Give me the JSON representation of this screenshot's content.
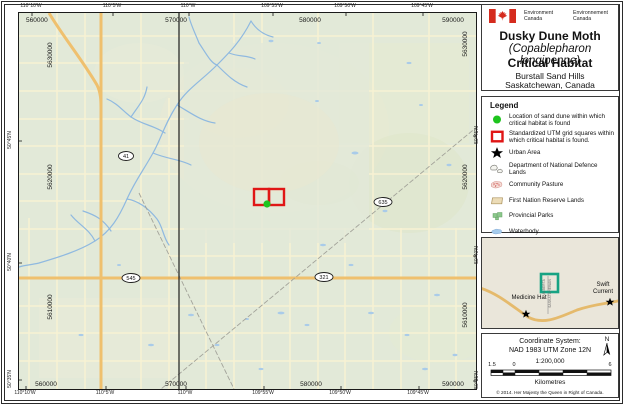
{
  "header": {
    "dept_en": "Environment\nCanada",
    "dept_fr": "Environnement\nCanada",
    "title_line1": "Dusky Dune Moth",
    "title_line2": "(Copablepharon longipenne)",
    "title_line3": "Critical Habitat",
    "subtitle_line1": "Burstall Sand Hills",
    "subtitle_line2": "Saskatchewan, Canada"
  },
  "legend": {
    "title": "Legend",
    "items": [
      {
        "symbol": "sand-dune-location-dot",
        "label": "Location of sand dune within which critical habitat is found"
      },
      {
        "symbol": "utm-grid-square",
        "label": "Standardized UTM grid squares within which critical habitat is found."
      },
      {
        "symbol": "urban-area-star",
        "label": "Urban Area"
      },
      {
        "symbol": "dnd-lands",
        "label": "Department of National Defence Lands"
      },
      {
        "symbol": "community-pasture",
        "label": "Community Pasture"
      },
      {
        "symbol": "first-nation-reserve-lands",
        "label": "First Nation Reserve Lands"
      },
      {
        "symbol": "provincial-parks",
        "label": "Provincial Parks"
      },
      {
        "symbol": "waterbody",
        "label": "Waterbody"
      },
      {
        "symbol": "province-state-boundary",
        "label": "Province/State Boundary"
      }
    ]
  },
  "map_labels": {
    "top_eastings": [
      "560000",
      "570000",
      "580000",
      "590000"
    ],
    "bottom_eastings": [
      "560000",
      "570000",
      "580000",
      "590000"
    ],
    "left_northings": [
      "5630000",
      "5620000",
      "5610000"
    ],
    "right_northings": [
      "5630000",
      "5620000",
      "5610000"
    ],
    "top_longitudes": [
      "110°10'W",
      "110°5'W",
      "110°W",
      "109°55'W",
      "109°50'W",
      "109°45'W"
    ],
    "bottom_longitudes": [
      "110°10'W",
      "110°5'W",
      "110°W",
      "109°55'W",
      "109°50'W",
      "109°45'W"
    ],
    "left_latitudes": [
      "50°45'N",
      "50°40'N",
      "50°35'N"
    ],
    "right_latitudes": [
      "50°45'N",
      "50°40'N",
      "50°35'N"
    ],
    "highways": {
      "h41": "41",
      "h635": "635",
      "h545": "545",
      "h321": "321"
    }
  },
  "inset": {
    "city1": "Medicine Hat",
    "city2": "Swift Current",
    "boundary_left": "ALBERTA",
    "boundary_right": "SASKATCHEWAN"
  },
  "footer": {
    "coord_line1": "Coordinate System:",
    "coord_line2": "NAD 1983 UTM Zone 12N",
    "scale_text": "1:200,000",
    "scalebar_left": "1.5",
    "scalebar_zero": "0",
    "scalebar_right": "6",
    "scalebar_unit": "Kilometres",
    "north_label": "N",
    "copyright": "© 2014. Her Majesty the Queen in Right of Canada."
  },
  "colors": {
    "critical_habitat_red": "#e01616",
    "sand_dune_green": "#1ec41e",
    "inset_extent_teal": "#17a383",
    "road_orange": "#efc06e",
    "water_blue": "#8fb9e0",
    "map_background": "#e2e9d8"
  }
}
